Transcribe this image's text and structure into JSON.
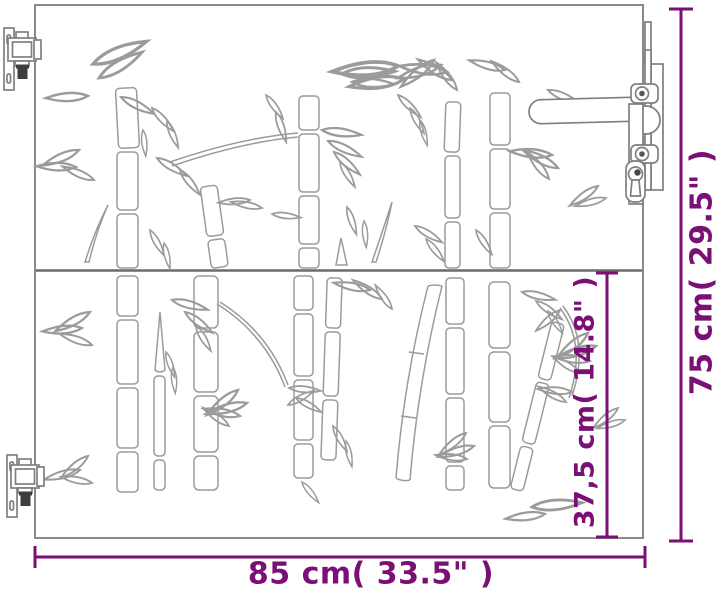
{
  "diagram": {
    "labels": {
      "width": "85 cm( 33.5\" )",
      "height": "75 cm( 29.5\" )",
      "section": "37,5 cm( 14.8\" )"
    },
    "colors": {
      "dimension_accent": "#7a1076",
      "line_art": "#9b9b9b",
      "outline": "#8a8a8a",
      "background": "#ffffff"
    }
  }
}
